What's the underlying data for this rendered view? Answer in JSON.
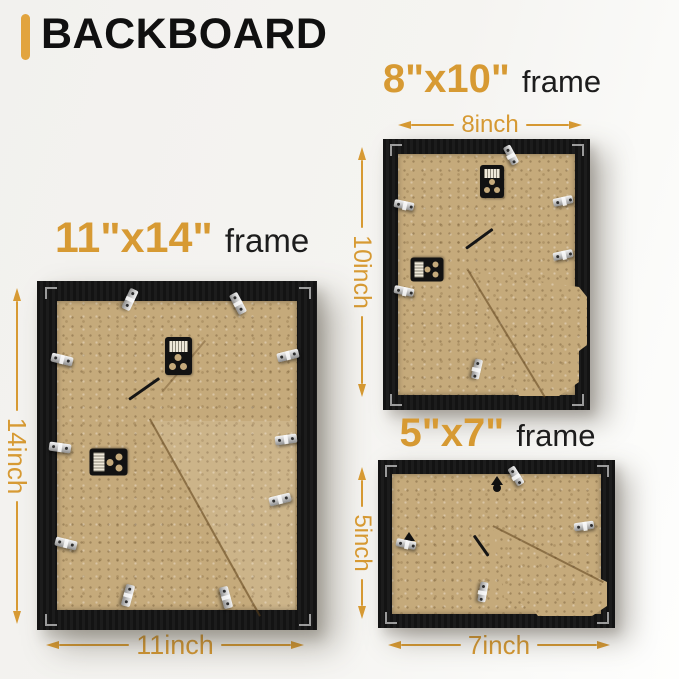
{
  "page": {
    "title": "BACKBOARD",
    "accent_color": "#D79A33",
    "title_bar_color": "#E2A43E",
    "frame_color": "#161616",
    "board_color": "#C5AA7B"
  },
  "frames": [
    {
      "name": "11x14",
      "size_label": "11\"x14\"",
      "frame_word": "frame",
      "width_label": "11inch",
      "height_label": "14inch"
    },
    {
      "name": "8x10",
      "size_label": "8\"x10\"",
      "frame_word": "frame",
      "width_label": "8inch",
      "height_label": "10inch"
    },
    {
      "name": "5x7",
      "size_label": "5\"x7\"",
      "frame_word": "frame",
      "width_label": "7inch",
      "height_label": "5inch"
    }
  ]
}
